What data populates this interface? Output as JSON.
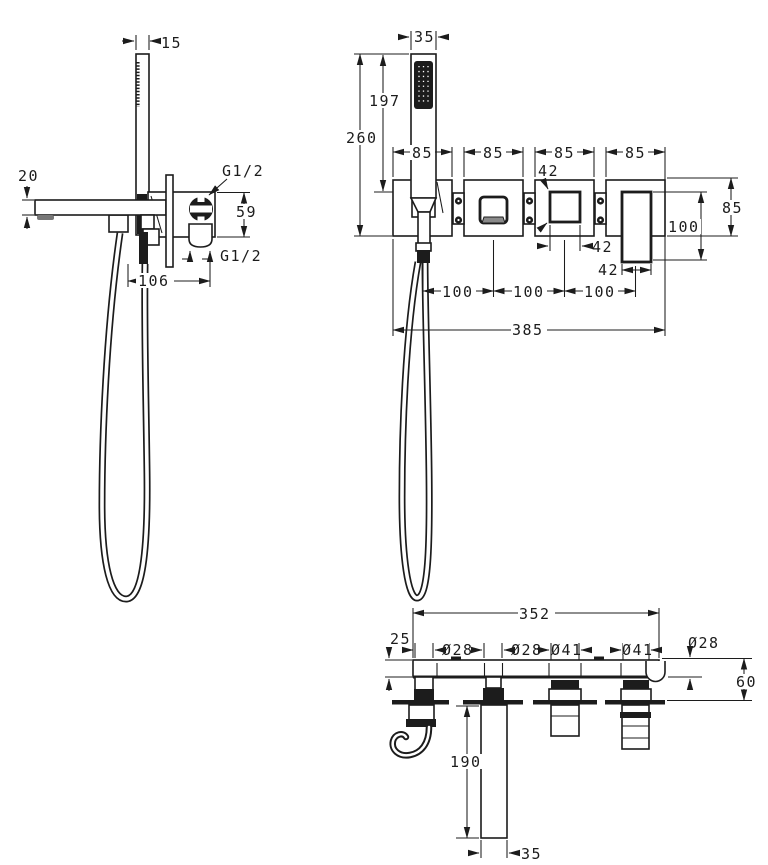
{
  "drawing": {
    "type": "technical-dimension-drawing",
    "colors": {
      "background": "#ffffff",
      "line": "#1c1c1c",
      "shade": "#8a8a8a"
    }
  },
  "side_view": {
    "dims": {
      "handset_thickness": "15",
      "spout_height": "20",
      "top_connection": "G1/2",
      "valve_height": "59",
      "bottom_connection": "G1/2",
      "spout_depth": "106"
    }
  },
  "front_view": {
    "dims": {
      "handset_width": "35",
      "handset_height": "197",
      "overall_height": "260",
      "plate1_width": "85",
      "plate2_width": "85",
      "plate3_width": "85",
      "plate4_width": "85",
      "knob_size": "42",
      "knob_width": "42",
      "lever_width": "42",
      "plate_height": "85",
      "lever_height": "100",
      "pitch1": "100",
      "pitch2": "100",
      "pitch3": "100",
      "overall_width": "385"
    }
  },
  "bottom_view": {
    "dims": {
      "body_width": "352",
      "body_thickness": "25",
      "dia_holder": "Ø28",
      "dia_spout": "Ø28",
      "dia_valve1": "Ø41",
      "dia_valve2": "Ø41",
      "dia_socket": "Ø28",
      "wall_distance": "60",
      "spout_length": "190",
      "spout_width": "35"
    }
  }
}
